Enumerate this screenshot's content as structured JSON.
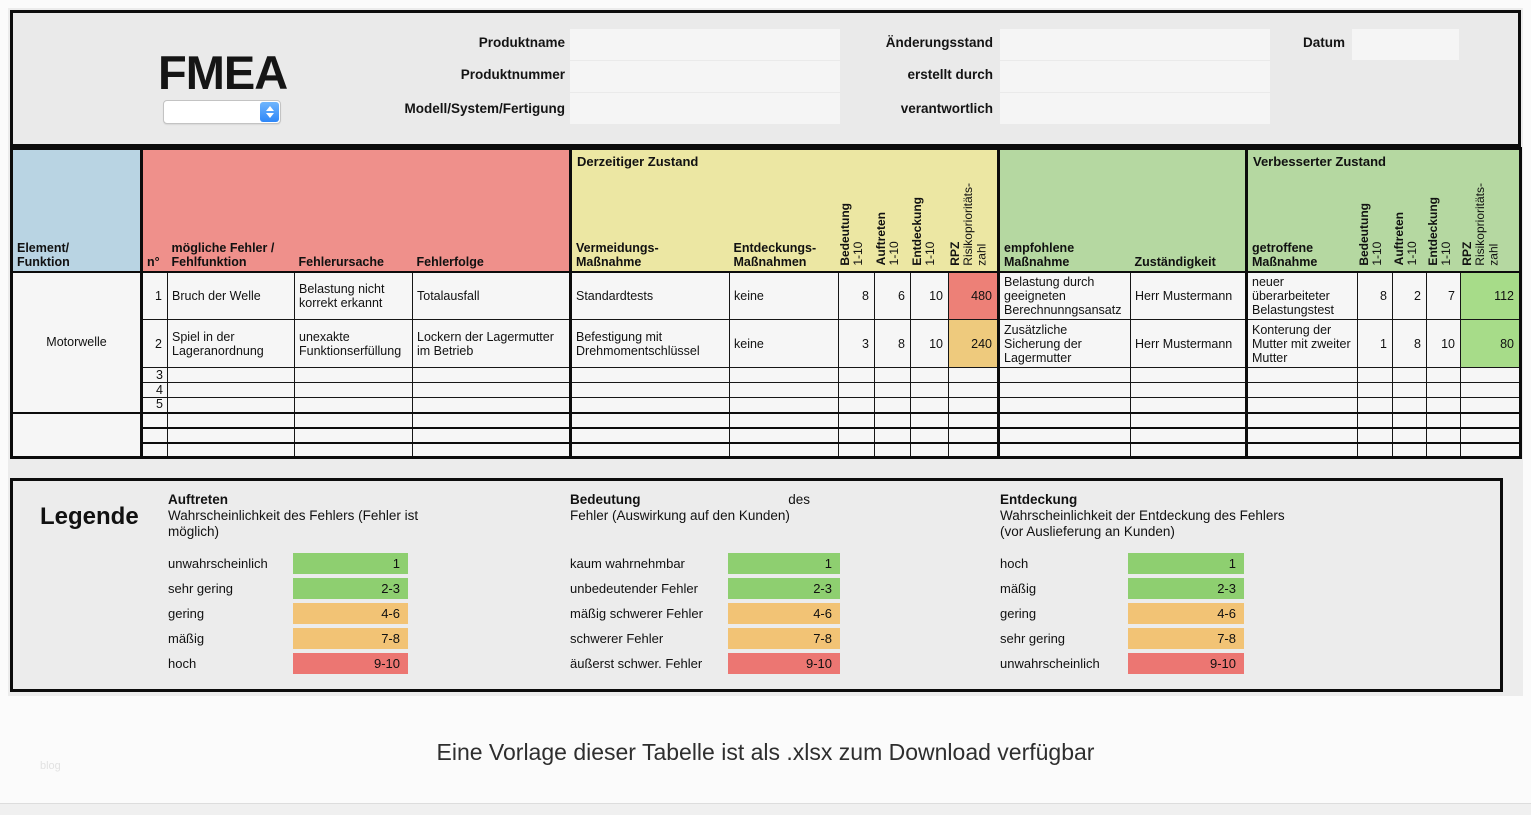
{
  "app": {
    "title": "FMEA"
  },
  "header": {
    "select": {
      "value": ""
    },
    "left_fields": [
      {
        "label": "Produktname",
        "value": ""
      },
      {
        "label": "Produktnummer",
        "value": ""
      },
      {
        "label": "Modell/System/Fertigung",
        "value": ""
      }
    ],
    "right_fields": [
      {
        "label": "Änderungsstand",
        "value": ""
      },
      {
        "label": "erstellt durch",
        "value": ""
      },
      {
        "label": "verantwortlich",
        "value": ""
      }
    ],
    "date_field": {
      "label": "Datum",
      "value": ""
    }
  },
  "table": {
    "group_titles": {
      "current": "Derzeitiger Zustand",
      "improved": "Verbesserter Zustand"
    },
    "columns": {
      "element": "Element/\nFunktion",
      "no": "n°",
      "possible_failure": "mögliche Fehler /\nFehlfunktion",
      "failure_cause": "Fehlerursache",
      "failure_effect": "Fehlerfolge",
      "prevention": "Vermeidungs-\nMaßnahme",
      "detection_measures": "Entdeckungs-\nMaßnahmen",
      "severity": {
        "name": "Bedeutung",
        "range": "1-10"
      },
      "occurrence": {
        "name": "Auftreten",
        "range": "1-10"
      },
      "detection": {
        "name": "Entdeckung",
        "range": "1-10"
      },
      "rpz": {
        "name": "RPZ",
        "range": "Risikoprioritäts-\nzahl"
      },
      "recommended": "empfohlene\nMaßnahme",
      "responsibility": "Zuständigkeit",
      "taken": "getroffene\nMaßnahme"
    },
    "element_groups": [
      {
        "label": "Motorwelle"
      },
      {
        "label": ""
      }
    ],
    "rows": [
      {
        "cells": [
          "1",
          "Bruch der Welle",
          "Belastung nicht korrekt erkannt",
          "Totalausfall",
          "Standardtests",
          "keine",
          "8",
          "6",
          "10",
          "480",
          "Belastung durch geeigneten Berechnunngsansatz",
          "Herr Mustermann",
          "neuer überarbeiteter Belastungstest",
          "8",
          "2",
          "7",
          "112"
        ]
      },
      {
        "cells": [
          "2",
          "Spiel in der Lageranordnung",
          "unexakte Funktionserfüllung",
          "Lockern der Lagermutter im Betrieb",
          "Befestigung mit Drehmomentschlüssel",
          "keine",
          "3",
          "8",
          "10",
          "240",
          "Zusätzliche Sicherung der Lagermutter",
          "Herr Mustermann",
          "Konterung der Mutter mit zweiter Mutter",
          "1",
          "8",
          "10",
          "80"
        ]
      },
      {
        "cells": [
          "3",
          "",
          "",
          "",
          "",
          "",
          "",
          "",
          "",
          "",
          "",
          "",
          "",
          "",
          "",
          "",
          ""
        ]
      },
      {
        "cells": [
          "4",
          "",
          "",
          "",
          "",
          "",
          "",
          "",
          "",
          "",
          "",
          "",
          "",
          "",
          "",
          "",
          ""
        ]
      },
      {
        "cells": [
          "5",
          "",
          "",
          "",
          "",
          "",
          "",
          "",
          "",
          "",
          "",
          "",
          "",
          "",
          "",
          "",
          ""
        ]
      },
      {
        "cells": [
          "",
          "",
          "",
          "",
          "",
          "",
          "",
          "",
          "",
          "",
          "",
          "",
          "",
          "",
          "",
          "",
          ""
        ]
      },
      {
        "cells": [
          "",
          "",
          "",
          "",
          "",
          "",
          "",
          "",
          "",
          "",
          "",
          "",
          "",
          "",
          "",
          "",
          ""
        ]
      },
      {
        "cells": [
          "",
          "",
          "",
          "",
          "",
          "",
          "",
          "",
          "",
          "",
          "",
          "",
          "",
          "",
          "",
          "",
          ""
        ]
      }
    ]
  },
  "legend": {
    "title": "Legende",
    "columns": [
      {
        "heading": "Auftreten",
        "heading_suffix": "",
        "desc": "Wahrscheinlichkeit des Fehlers (Fehler ist möglich)",
        "items": [
          {
            "label": "unwahrscheinlich",
            "range": "1",
            "level": "green"
          },
          {
            "label": "sehr gering",
            "range": "2-3",
            "level": "green"
          },
          {
            "label": "gering",
            "range": "4-6",
            "level": "orange"
          },
          {
            "label": "mäßig",
            "range": "7-8",
            "level": "orange"
          },
          {
            "label": "hoch",
            "range": "9-10",
            "level": "red"
          }
        ]
      },
      {
        "heading": "Bedeutung",
        "heading_suffix": "des",
        "desc": "Fehler (Auswirkung auf den Kunden)",
        "items": [
          {
            "label": "kaum wahrnehmbar",
            "range": "1",
            "level": "green"
          },
          {
            "label": "unbedeutender Fehler",
            "range": "2-3",
            "level": "green"
          },
          {
            "label": "mäßig schwerer Fehler",
            "range": "4-6",
            "level": "orange"
          },
          {
            "label": "schwerer Fehler",
            "range": "7-8",
            "level": "orange"
          },
          {
            "label": "äußerst schwer. Fehler",
            "range": "9-10",
            "level": "red"
          }
        ]
      },
      {
        "heading": "Entdeckung",
        "heading_suffix": "",
        "desc": "Wahrscheinlichkeit der Entdeckung des Fehlers (vor Auslieferung an Kunden)",
        "items": [
          {
            "label": "hoch",
            "range": "1",
            "level": "green"
          },
          {
            "label": "mäßig",
            "range": "2-3",
            "level": "green"
          },
          {
            "label": "gering",
            "range": "4-6",
            "level": "orange"
          },
          {
            "label": "sehr gering",
            "range": "7-8",
            "level": "orange"
          },
          {
            "label": "unwahrscheinlich",
            "range": "9-10",
            "level": "red"
          }
        ]
      }
    ]
  },
  "footer": {
    "caption": "Eine Vorlage dieser Tabelle ist als .xlsx zum Download verfügbar",
    "watermark": "blog"
  },
  "colors": {
    "header_blue": "#b9d4e3",
    "header_red": "#ef908b",
    "header_yellow": "#ece7a3",
    "header_green": "#b5d8a1",
    "rpz_high": "#ed8077",
    "rpz_mid": "#eeca7d",
    "rpz_low": "#a7dc89",
    "legend_green": "#8ecf70",
    "legend_orange": "#f2c375",
    "legend_red": "#ec7672",
    "select_blue": "#2e87f8",
    "cell_bg": "#f6f6f6",
    "panel_bg": "#ececec"
  }
}
